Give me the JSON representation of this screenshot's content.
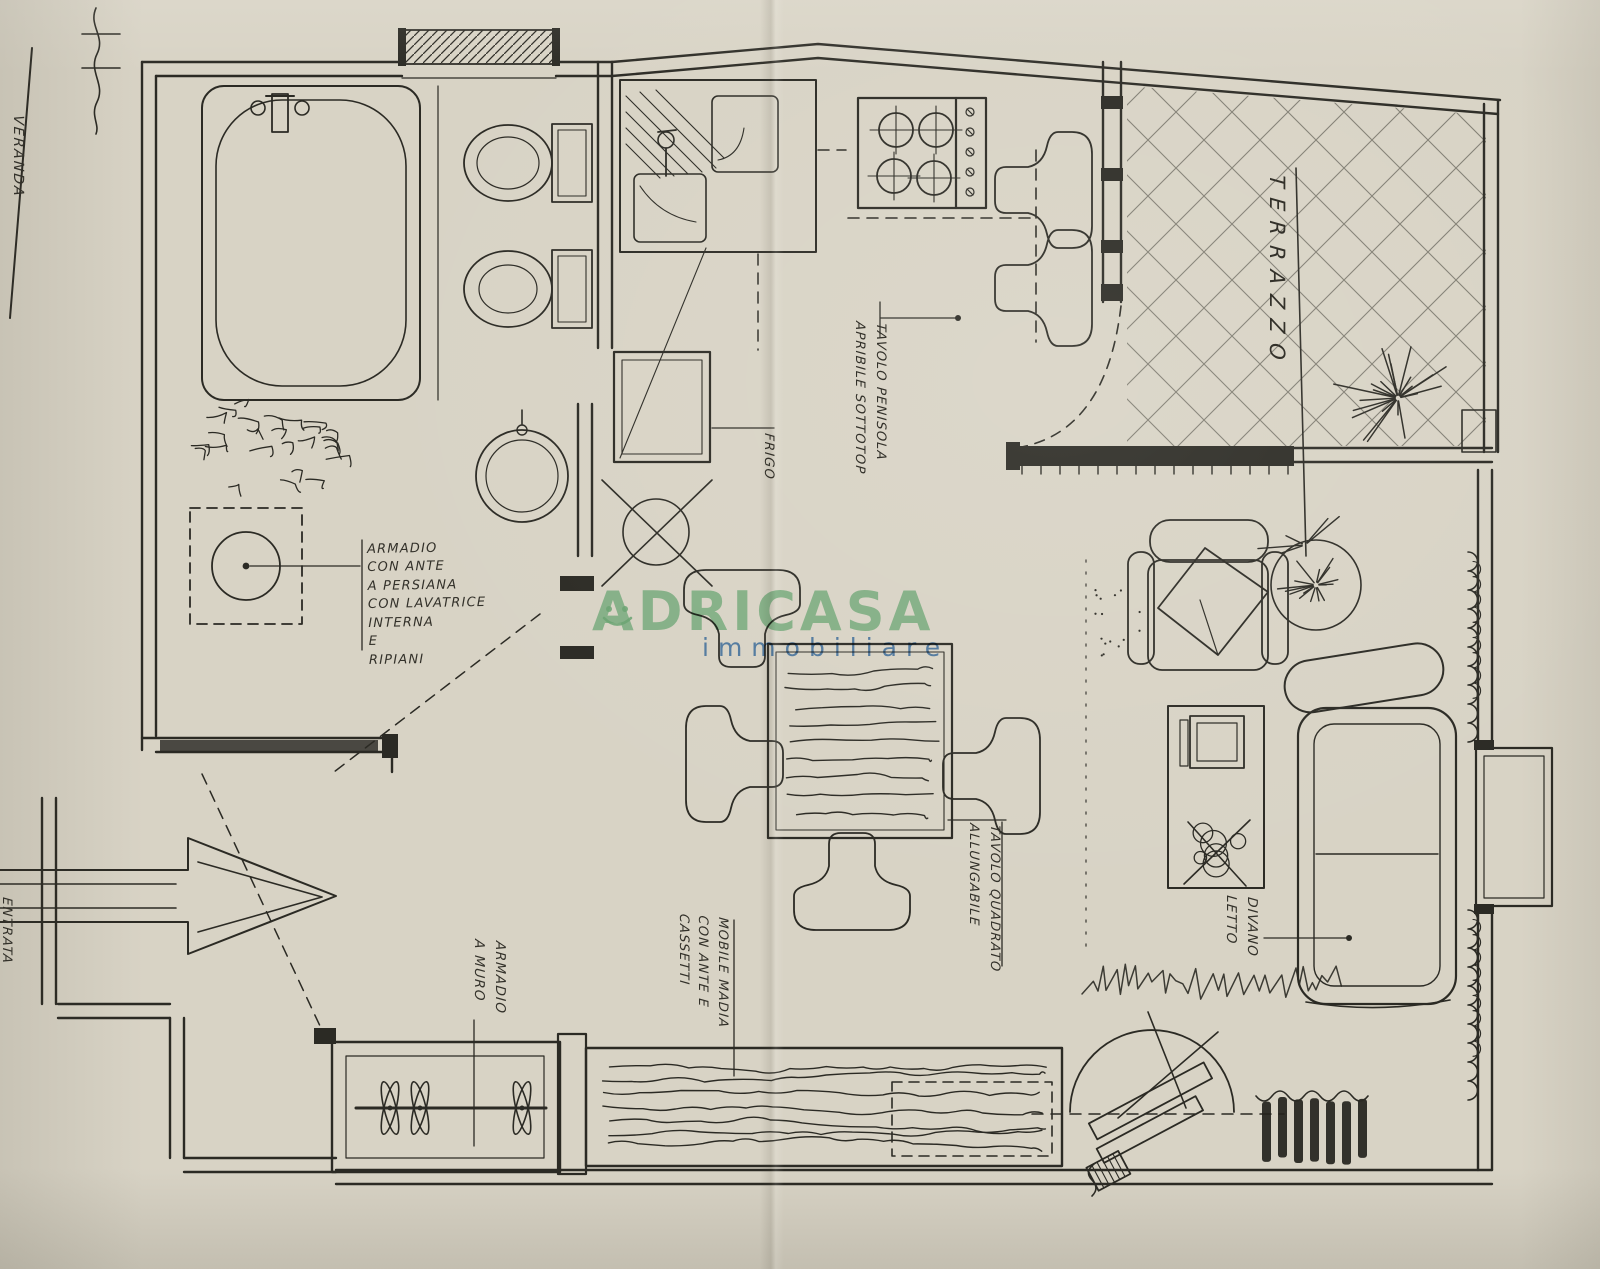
{
  "paper": {
    "background": "#d8d3c5",
    "ink": "#2b2a24"
  },
  "watermark": {
    "brand": "ADRICASA",
    "subtitle": "immobiliare",
    "brand_color": "#7ec492",
    "subtitle_color": "#4a84c6"
  },
  "labels": {
    "veranda": "VERANDA",
    "terrace": "TERRAZZO",
    "fridge": "FRIGO",
    "peninsula_table": "TAVOLO PENISOLA\nAPRIBILE SOTTOTOP",
    "louvre_wardrobe": "ARMADIO\nCON ANTE\nA PERSIANA\nCON LAVATRICE\nINTERNA\nE\nRIPIANI",
    "square_table": "TAVOLO QUADRATO\nALLUNGABILE",
    "sideboard": "MOBILE MADIA\nCON ANTE E\nCASSETTI",
    "wall_wardrobe": "ARMADIO\nA MURO",
    "sofa_bed": "DIVANO\nLETTO",
    "entry": "ENTRATA"
  }
}
